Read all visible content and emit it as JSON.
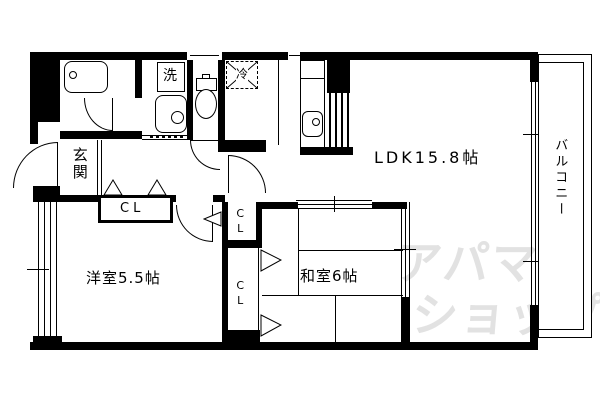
{
  "title": "apartment-floor-plan",
  "colors": {
    "background": "#ffffff",
    "wall": "#000000",
    "watermark": "#e2e2e2"
  },
  "labels": {
    "ldk": "LDK15.8帖",
    "western_room": "洋室5.5帖",
    "japanese_room": "和室6帖",
    "entrance": "玄関",
    "closet_hall": "CL",
    "closet_upper": "CL",
    "closet_lower": "CL",
    "washer": "洗",
    "refrigerator": "冷",
    "balcony": "バルコニー"
  },
  "watermark": {
    "line1": "アパマン",
    "line2": "ショップ",
    "mark": "TM"
  }
}
